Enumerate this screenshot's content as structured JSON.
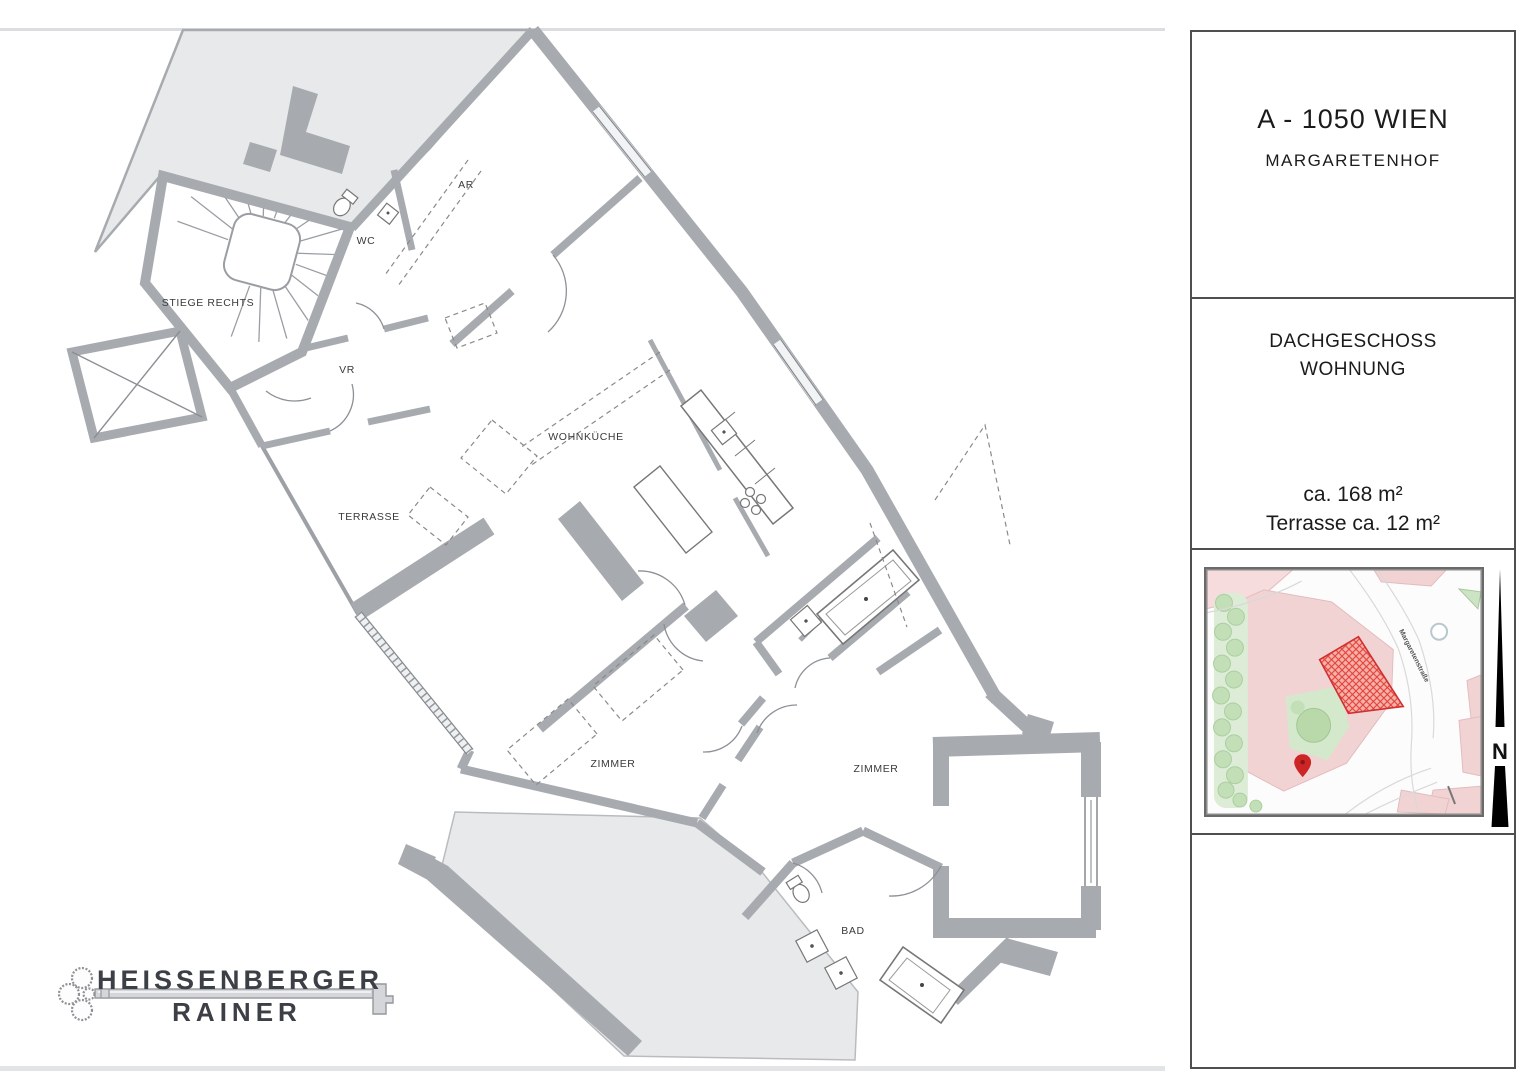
{
  "plan": {
    "rooms": [
      {
        "label": "STIEGE RECHTS"
      },
      {
        "label": "WC"
      },
      {
        "label": "AR"
      },
      {
        "label": "VR"
      },
      {
        "label": "WOHNKÜCHE"
      },
      {
        "label": "TERRASSE"
      },
      {
        "label": "ZIMMER"
      },
      {
        "label": "ZIMMER"
      },
      {
        "label": "BAD"
      }
    ],
    "logo": {
      "line1": "HEISSENBERGER",
      "line2": "RAINER"
    }
  },
  "panel": {
    "address": {
      "line1": "A - 1050 WIEN",
      "line2": "MARGARETENHOF"
    },
    "unit": {
      "line1": "DACHGESCHOSS",
      "line2": "WOHNUNG"
    },
    "areas": {
      "total": "ca. 168 m²",
      "terrace": "Terrasse ca. 12 m²"
    },
    "map": {
      "street_label": "Margaretenstraße"
    },
    "north": {
      "label": "N"
    }
  },
  "colors": {
    "wall": "#a7abb0",
    "shaded_area": "#e8e9ea",
    "map_block_pink": "#f2d3d4",
    "map_green": "#cfe6c6",
    "map_highlight_red": "#e04038",
    "map_pin_red": "#cc2525",
    "north_arrow": "#000000"
  }
}
